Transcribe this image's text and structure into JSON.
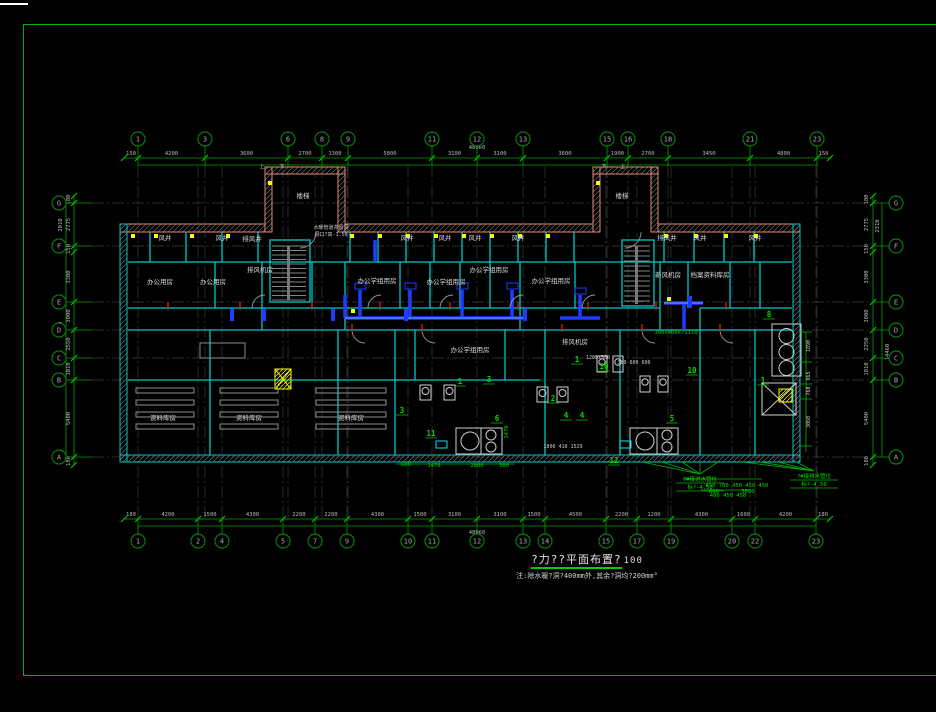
{
  "colors": {
    "background": "#000000",
    "frame_green": "#00b400",
    "grid_green": "#00a000",
    "bubble_green": "#0a7a0a",
    "dim_text": "#b9b9b9",
    "wall_cyan": "#00c8c8",
    "wall_salmon": "#e58a70",
    "duct_blue": "#1e3cff",
    "annotation_green": "#00dc00",
    "equipment_white": "#cfcfcf",
    "marker_yellow": "#ffff00",
    "mark_red": "#cc2200",
    "text_white": "#d8d8d8"
  },
  "title_block": {
    "title": "?力??平面布置?",
    "scale": "100",
    "note": "注:除水暖?洞?400mm外,其余?洞均?200mm°"
  },
  "grid": {
    "top": {
      "y": 139,
      "bubbles": [
        {
          "label": "1",
          "x": 138
        },
        {
          "label": "3",
          "x": 205
        },
        {
          "label": "6",
          "x": 288
        },
        {
          "label": "8",
          "x": 322
        },
        {
          "label": "9",
          "x": 348
        },
        {
          "label": "11",
          "x": 432
        },
        {
          "label": "12",
          "x": 477
        },
        {
          "label": "13",
          "x": 523
        },
        {
          "label": "15",
          "x": 607
        },
        {
          "label": "16",
          "x": 628
        },
        {
          "label": "18",
          "x": 668
        },
        {
          "label": "21",
          "x": 750
        },
        {
          "label": "23",
          "x": 817
        }
      ],
      "ticks": [
        124,
        138,
        205,
        288,
        322,
        348,
        432,
        477,
        523,
        607,
        628,
        668,
        750,
        817,
        830
      ],
      "dims": [
        "150",
        "4200",
        "3600",
        "2700",
        "1300",
        "5800",
        "3100",
        "3100",
        "3600",
        "1900",
        "2700",
        "3450",
        "4800",
        "150"
      ],
      "total": "48060"
    },
    "bottom": {
      "y": 541,
      "bubbles": [
        {
          "label": "1",
          "x": 138
        },
        {
          "label": "2",
          "x": 198
        },
        {
          "label": "4",
          "x": 222
        },
        {
          "label": "5",
          "x": 283
        },
        {
          "label": "7",
          "x": 315
        },
        {
          "label": "9",
          "x": 347
        },
        {
          "label": "10",
          "x": 408
        },
        {
          "label": "11",
          "x": 432
        },
        {
          "label": "12",
          "x": 477
        },
        {
          "label": "13",
          "x": 523
        },
        {
          "label": "14",
          "x": 545
        },
        {
          "label": "15",
          "x": 606
        },
        {
          "label": "17",
          "x": 637
        },
        {
          "label": "19",
          "x": 671
        },
        {
          "label": "20",
          "x": 732
        },
        {
          "label": "22",
          "x": 755
        },
        {
          "label": "23",
          "x": 816
        }
      ],
      "ticks": [
        124,
        138,
        198,
        222,
        283,
        315,
        347,
        408,
        432,
        477,
        523,
        545,
        606,
        637,
        671,
        732,
        755,
        816,
        830
      ],
      "dims": [
        "180",
        "4200",
        "1500",
        "4300",
        "2200",
        "2200",
        "4300",
        "1500",
        "3100",
        "3100",
        "1500",
        "4500",
        "2200",
        "1200",
        "4300",
        "1600",
        "4200",
        "180"
      ],
      "total": "48060"
    },
    "left": {
      "x": 59,
      "bubbles": [
        {
          "label": "G",
          "y": 203
        },
        {
          "label": "F",
          "y": 246
        },
        {
          "label": "E",
          "y": 302
        },
        {
          "label": "D",
          "y": 330
        },
        {
          "label": "C",
          "y": 358
        },
        {
          "label": "B",
          "y": 380
        },
        {
          "label": "A",
          "y": 457
        }
      ],
      "ticks": [
        196,
        203,
        246,
        252,
        302,
        330,
        358,
        380,
        457,
        465
      ],
      "dims": [
        "180",
        "2775",
        "150",
        "3300",
        "3000",
        "2550",
        "1010",
        "5400",
        "180"
      ],
      "total": "14460",
      "outer": "2010"
    },
    "right": {
      "x": 896,
      "bubbles": [
        {
          "label": "G",
          "y": 203
        },
        {
          "label": "F",
          "y": 246
        },
        {
          "label": "E",
          "y": 302
        },
        {
          "label": "D",
          "y": 330
        },
        {
          "label": "C",
          "y": 358
        },
        {
          "label": "B",
          "y": 380
        },
        {
          "label": "A",
          "y": 457
        }
      ],
      "ticks": [
        196,
        203,
        246,
        252,
        302,
        330,
        358,
        380,
        457,
        465
      ],
      "dims": [
        "180",
        "2775",
        "150",
        "3300",
        "3000",
        "2250",
        "1010",
        "5400",
        "180"
      ],
      "total": "14460",
      "outer": "2310"
    }
  },
  "rooms": [
    {
      "t": "楼梯",
      "x": 303,
      "y": 198
    },
    {
      "t": "楼梯",
      "x": 622,
      "y": 198
    },
    {
      "t": "风井",
      "x": 165,
      "y": 240
    },
    {
      "t": "风井",
      "x": 222,
      "y": 240
    },
    {
      "t": "排风井",
      "x": 252,
      "y": 241
    },
    {
      "t": "风井",
      "x": 407,
      "y": 240
    },
    {
      "t": "风井",
      "x": 445,
      "y": 240
    },
    {
      "t": "风井",
      "x": 475,
      "y": 240
    },
    {
      "t": "风井",
      "x": 518,
      "y": 240
    },
    {
      "t": "排风井",
      "x": 667,
      "y": 240
    },
    {
      "t": "风井",
      "x": 700,
      "y": 240
    },
    {
      "t": "风井",
      "x": 755,
      "y": 240
    },
    {
      "t": "办公用房",
      "x": 160,
      "y": 284
    },
    {
      "t": "办公用房",
      "x": 213,
      "y": 284
    },
    {
      "t": "排风机房",
      "x": 260,
      "y": 272
    },
    {
      "t": "办公学组用房",
      "x": 377,
      "y": 283
    },
    {
      "t": "办公学组用房",
      "x": 446,
      "y": 284
    },
    {
      "t": "办公学组用房",
      "x": 489,
      "y": 272
    },
    {
      "t": "办公学组用房",
      "x": 551,
      "y": 283
    },
    {
      "t": "新风机房",
      "x": 668,
      "y": 277
    },
    {
      "t": "档案资料库房",
      "x": 710,
      "y": 277
    },
    {
      "t": "办公学组用房",
      "x": 470,
      "y": 352
    },
    {
      "t": "排风机房",
      "x": 575,
      "y": 344
    },
    {
      "t": "资料库房",
      "x": 163,
      "y": 420
    },
    {
      "t": "资料库房",
      "x": 249,
      "y": 420
    },
    {
      "t": "资料库房",
      "x": 351,
      "y": 420
    }
  ],
  "notes": [
    {
      "t": "水暖管道井留洞",
      "x": 331,
      "y": 229
    },
    {
      "t": "洞口?高-1.50",
      "x": 331,
      "y": 236
    }
  ],
  "plan_texts": [
    {
      "t": "上",
      "x": 262,
      "y": 168,
      "c": "w"
    },
    {
      "t": "下",
      "x": 282,
      "y": 168,
      "c": "w"
    },
    {
      "t": "下",
      "x": 604,
      "y": 168,
      "c": "w"
    },
    {
      "t": "上",
      "x": 623,
      "y": 168,
      "c": "w"
    },
    {
      "t": "1200x500",
      "x": 598,
      "y": 359,
      "c": "w"
    },
    {
      "t": "300 600 600",
      "x": 634,
      "y": 364,
      "c": "w"
    },
    {
      "t": "1800 410 1529",
      "x": 563,
      "y": 448,
      "c": "w"
    },
    {
      "t": "300x400x?1110",
      "x": 676,
      "y": 334,
      "c": "g"
    },
    {
      "t": "600",
      "x": 406,
      "y": 466,
      "c": "g"
    },
    {
      "t": "1470",
      "x": 434,
      "y": 467,
      "c": "g"
    },
    {
      "t": "2800",
      "x": 477,
      "y": 467,
      "c": "g"
    },
    {
      "t": "300",
      "x": 504,
      "y": 467,
      "c": "g"
    },
    {
      "t": "600",
      "x": 714,
      "y": 493,
      "c": "g"
    },
    {
      "t": "3600",
      "x": 748,
      "y": 493,
      "c": "g"
    },
    {
      "t": "450 700 450 450 450",
      "x": 737,
      "y": 487,
      "c": "g"
    },
    {
      "t": "400 450 450",
      "x": 728,
      "y": 497,
      "c": "g"
    },
    {
      "t": "1890",
      "x": 810,
      "y": 346,
      "c": "w",
      "r": 1
    },
    {
      "t": "865",
      "x": 810,
      "y": 376,
      "c": "w",
      "r": 1
    },
    {
      "t": "760",
      "x": 810,
      "y": 391,
      "c": "w",
      "r": 1
    },
    {
      "t": "3060",
      "x": 810,
      "y": 422,
      "c": "w",
      "r": 1
    },
    {
      "t": "1470",
      "x": 508,
      "y": 432,
      "c": "g",
      "r": 1
    }
  ],
  "callouts": [
    {
      "n": "1",
      "x": 460,
      "y": 384
    },
    {
      "n": "3",
      "x": 489,
      "y": 382
    },
    {
      "n": "2",
      "x": 553,
      "y": 401
    },
    {
      "n": "6",
      "x": 497,
      "y": 421
    },
    {
      "n": "11",
      "x": 431,
      "y": 436
    },
    {
      "n": "3",
      "x": 402,
      "y": 413
    },
    {
      "n": "4",
      "x": 566,
      "y": 418
    },
    {
      "n": "4",
      "x": 582,
      "y": 418
    },
    {
      "n": "12",
      "x": 614,
      "y": 463
    },
    {
      "n": "10",
      "x": 604,
      "y": 369
    },
    {
      "n": "1",
      "x": 577,
      "y": 362
    },
    {
      "n": "8",
      "x": 769,
      "y": 317
    },
    {
      "n": "10",
      "x": 692,
      "y": 373
    },
    {
      "n": "1",
      "x": 763,
      "y": 383
    },
    {
      "n": "5",
      "x": 672,
      "y": 421
    }
  ],
  "annotations": [
    {
      "t": "7#接进水管位",
      "x": 700,
      "y": 481
    },
    {
      "t": "标?-4.50",
      "x": 700,
      "y": 489
    },
    {
      "t": "?#接排水管位",
      "x": 814,
      "y": 478
    },
    {
      "t": "标?-4.50",
      "x": 814,
      "y": 486
    }
  ]
}
